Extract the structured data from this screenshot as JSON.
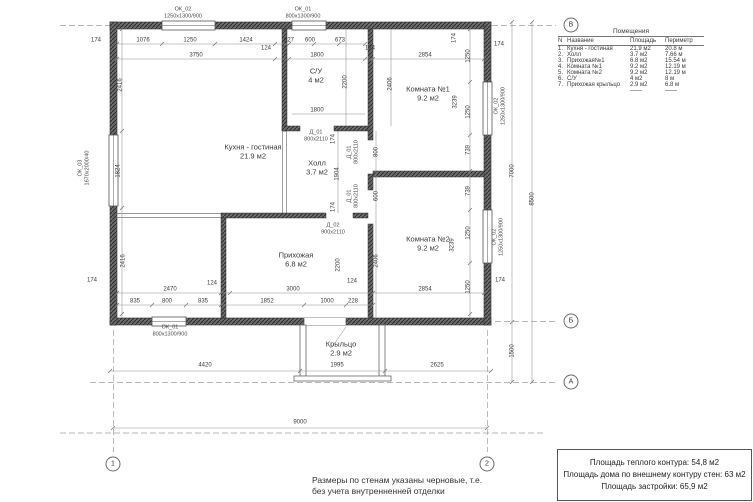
{
  "legend": {
    "title": "Помещения",
    "headers": [
      "N",
      "Название",
      "Площадь",
      "Периметр"
    ],
    "rows": [
      [
        "1.",
        "Кухня - гостиная",
        "21.9 м2",
        "20.8 м"
      ],
      [
        "2.",
        "Холл",
        "3.7 м2",
        "7.66 м"
      ],
      [
        "3.",
        "Прихожая№1",
        "6.8 м2",
        "15.54 м"
      ],
      [
        "4.",
        "Комната №1",
        "9.2 м2",
        "12.19 м"
      ],
      [
        "5.",
        "Комната №2",
        "9.2 м2",
        "12.19 м"
      ],
      [
        "6.",
        "С/У",
        "4 м2",
        "8 м"
      ],
      [
        "7.",
        "Прихожая крыльцо",
        "2.9 м2",
        "6.8 м"
      ],
      [
        "",
        "",
        "——",
        "——"
      ]
    ]
  },
  "summary": {
    "lines": [
      "Площадь теплого контура: 54,8 м2",
      "Площадь дома по внешнему контуру стен: 63 м2",
      "Площадь застройки: 65,9 м2"
    ]
  },
  "note": {
    "lines": [
      "Размеры по стенам указаны черновые, т.е.",
      "без учета внутренненней отделки"
    ]
  },
  "plan": {
    "rooms": [
      {
        "name": "Кухня - гостиная",
        "area": "21.9 м2",
        "x": 253,
        "y": 152
      },
      {
        "name": "С/У",
        "area": "4 м2",
        "x": 316,
        "y": 76
      },
      {
        "name": "Комната №1",
        "area": "9.2 м2",
        "x": 428,
        "y": 94
      },
      {
        "name": "Холл",
        "area": "3.7 м2",
        "x": 317,
        "y": 168
      },
      {
        "name": "Комната №2",
        "area": "9.2 м2",
        "x": 428,
        "y": 244
      },
      {
        "name": "Прихожая",
        "area": "6.8 м2",
        "x": 296,
        "y": 260
      },
      {
        "name": "Крыльцо",
        "area": "2.9 м2",
        "x": 341,
        "y": 349
      }
    ],
    "openings": [
      {
        "tag": "ОК_02",
        "size": "1250х1300/900",
        "x": 183,
        "y": 13,
        "r": 0
      },
      {
        "tag": "ОК_01",
        "size": "800х1300/900",
        "x": 303,
        "y": 13,
        "r": 0
      },
      {
        "tag": "ОК_02",
        "size": "1250х1300/900",
        "x": 500,
        "y": 106,
        "r": 1
      },
      {
        "tag": "ОК_02",
        "size": "1250х1300/900",
        "x": 498,
        "y": 237,
        "r": 1
      },
      {
        "tag": "ОК_03",
        "size": "1670х2000/40",
        "x": 84,
        "y": 168,
        "r": 1
      },
      {
        "tag": "ОК_01",
        "size": "800х1300/900",
        "x": 170,
        "y": 331,
        "r": 0
      },
      {
        "tag": "Д_01",
        "size": "800х2110",
        "x": 316,
        "y": 136,
        "r": 0
      },
      {
        "tag": "Д_01",
        "size": "800х2110",
        "x": 353,
        "y": 152,
        "r": 1
      },
      {
        "tag": "Д_01",
        "size": "800х2110",
        "x": 353,
        "y": 196,
        "r": 1
      },
      {
        "tag": "Д_02",
        "size": "900х2110",
        "x": 333,
        "y": 229,
        "r": 0
      }
    ],
    "dims": [
      {
        "v": "174",
        "x": 96,
        "y": 41,
        "r": 0
      },
      {
        "v": "1076",
        "x": 143,
        "y": 41,
        "r": 0
      },
      {
        "v": "1250",
        "x": 190,
        "y": 41,
        "r": 0
      },
      {
        "v": "1424",
        "x": 246,
        "y": 41,
        "r": 0
      },
      {
        "v": "327",
        "x": 289,
        "y": 41,
        "r": 0
      },
      {
        "v": "600",
        "x": 310,
        "y": 41,
        "r": 0
      },
      {
        "v": "673",
        "x": 340,
        "y": 41,
        "r": 0
      },
      {
        "v": "124",
        "x": 266,
        "y": 49,
        "r": 0
      },
      {
        "v": "124",
        "x": 370,
        "y": 49,
        "r": 0
      },
      {
        "v": "3750",
        "x": 196,
        "y": 56,
        "r": 0
      },
      {
        "v": "1800",
        "x": 317,
        "y": 56,
        "r": 0
      },
      {
        "v": "2854",
        "x": 425,
        "y": 56,
        "r": 0
      },
      {
        "v": "174",
        "x": 455,
        "y": 38,
        "r": 1
      },
      {
        "v": "174",
        "x": 499,
        "y": 45,
        "r": 0
      },
      {
        "v": "2416",
        "x": 121,
        "y": 85,
        "r": 1
      },
      {
        "v": "1824",
        "x": 119,
        "y": 171,
        "r": 1
      },
      {
        "v": "2416",
        "x": 124,
        "y": 261,
        "r": 1
      },
      {
        "v": "174",
        "x": 92,
        "y": 281,
        "r": 0
      },
      {
        "v": "2200",
        "x": 346,
        "y": 82,
        "r": 1
      },
      {
        "v": "1800",
        "x": 317,
        "y": 111,
        "r": 0
      },
      {
        "v": "2406",
        "x": 391,
        "y": 84,
        "r": 1
      },
      {
        "v": "1250",
        "x": 469,
        "y": 56,
        "r": 1
      },
      {
        "v": "1250",
        "x": 469,
        "y": 112,
        "r": 1
      },
      {
        "v": "3239",
        "x": 456,
        "y": 102,
        "r": 1
      },
      {
        "v": "739",
        "x": 469,
        "y": 150,
        "r": 1
      },
      {
        "v": "174",
        "x": 334,
        "y": 139,
        "r": 1
      },
      {
        "v": "800",
        "x": 377,
        "y": 152,
        "r": 1
      },
      {
        "v": "1904",
        "x": 338,
        "y": 174,
        "r": 1
      },
      {
        "v": "600",
        "x": 377,
        "y": 196,
        "r": 1
      },
      {
        "v": "174",
        "x": 334,
        "y": 207,
        "r": 1
      },
      {
        "v": "739",
        "x": 469,
        "y": 191,
        "r": 1
      },
      {
        "v": "1250",
        "x": 469,
        "y": 233,
        "r": 1
      },
      {
        "v": "3239",
        "x": 453,
        "y": 245,
        "r": 1
      },
      {
        "v": "1250",
        "x": 469,
        "y": 287,
        "r": 1
      },
      {
        "v": "2406",
        "x": 377,
        "y": 261,
        "r": 1
      },
      {
        "v": "174",
        "x": 500,
        "y": 281,
        "r": 0
      },
      {
        "v": "2854",
        "x": 425,
        "y": 290,
        "r": 0
      },
      {
        "v": "124",
        "x": 352,
        "y": 282,
        "r": 0
      },
      {
        "v": "228",
        "x": 353,
        "y": 302,
        "r": 0
      },
      {
        "v": "2470",
        "x": 170,
        "y": 290,
        "r": 0
      },
      {
        "v": "3000",
        "x": 293,
        "y": 290,
        "r": 0
      },
      {
        "v": "124",
        "x": 212,
        "y": 284,
        "r": 0
      },
      {
        "v": "2200",
        "x": 339,
        "y": 265,
        "r": 1
      },
      {
        "v": "835",
        "x": 135,
        "y": 302,
        "r": 0
      },
      {
        "v": "800",
        "x": 167,
        "y": 302,
        "r": 0
      },
      {
        "v": "835",
        "x": 203,
        "y": 302,
        "r": 0
      },
      {
        "v": "1852",
        "x": 267,
        "y": 302,
        "r": 0
      },
      {
        "v": "1000",
        "x": 327,
        "y": 302,
        "r": 0
      },
      {
        "v": "4420",
        "x": 205,
        "y": 366,
        "r": 0
      },
      {
        "v": "1995",
        "x": 337,
        "y": 366,
        "r": 0
      },
      {
        "v": "2625",
        "x": 437,
        "y": 366,
        "r": 0
      },
      {
        "v": "9000",
        "x": 300,
        "y": 423,
        "r": 0
      },
      {
        "v": "7000",
        "x": 513,
        "y": 171,
        "r": 1
      },
      {
        "v": "8500",
        "x": 533,
        "y": 199,
        "r": 1
      },
      {
        "v": "1500",
        "x": 513,
        "y": 351,
        "r": 1
      }
    ],
    "markers": [
      {
        "label": "В",
        "x": 571,
        "y": 25
      },
      {
        "label": "Б",
        "x": 571,
        "y": 321
      },
      {
        "label": "А",
        "x": 571,
        "y": 382
      },
      {
        "label": "1",
        "x": 113,
        "y": 464
      },
      {
        "label": "2",
        "x": 487,
        "y": 464
      }
    ]
  }
}
